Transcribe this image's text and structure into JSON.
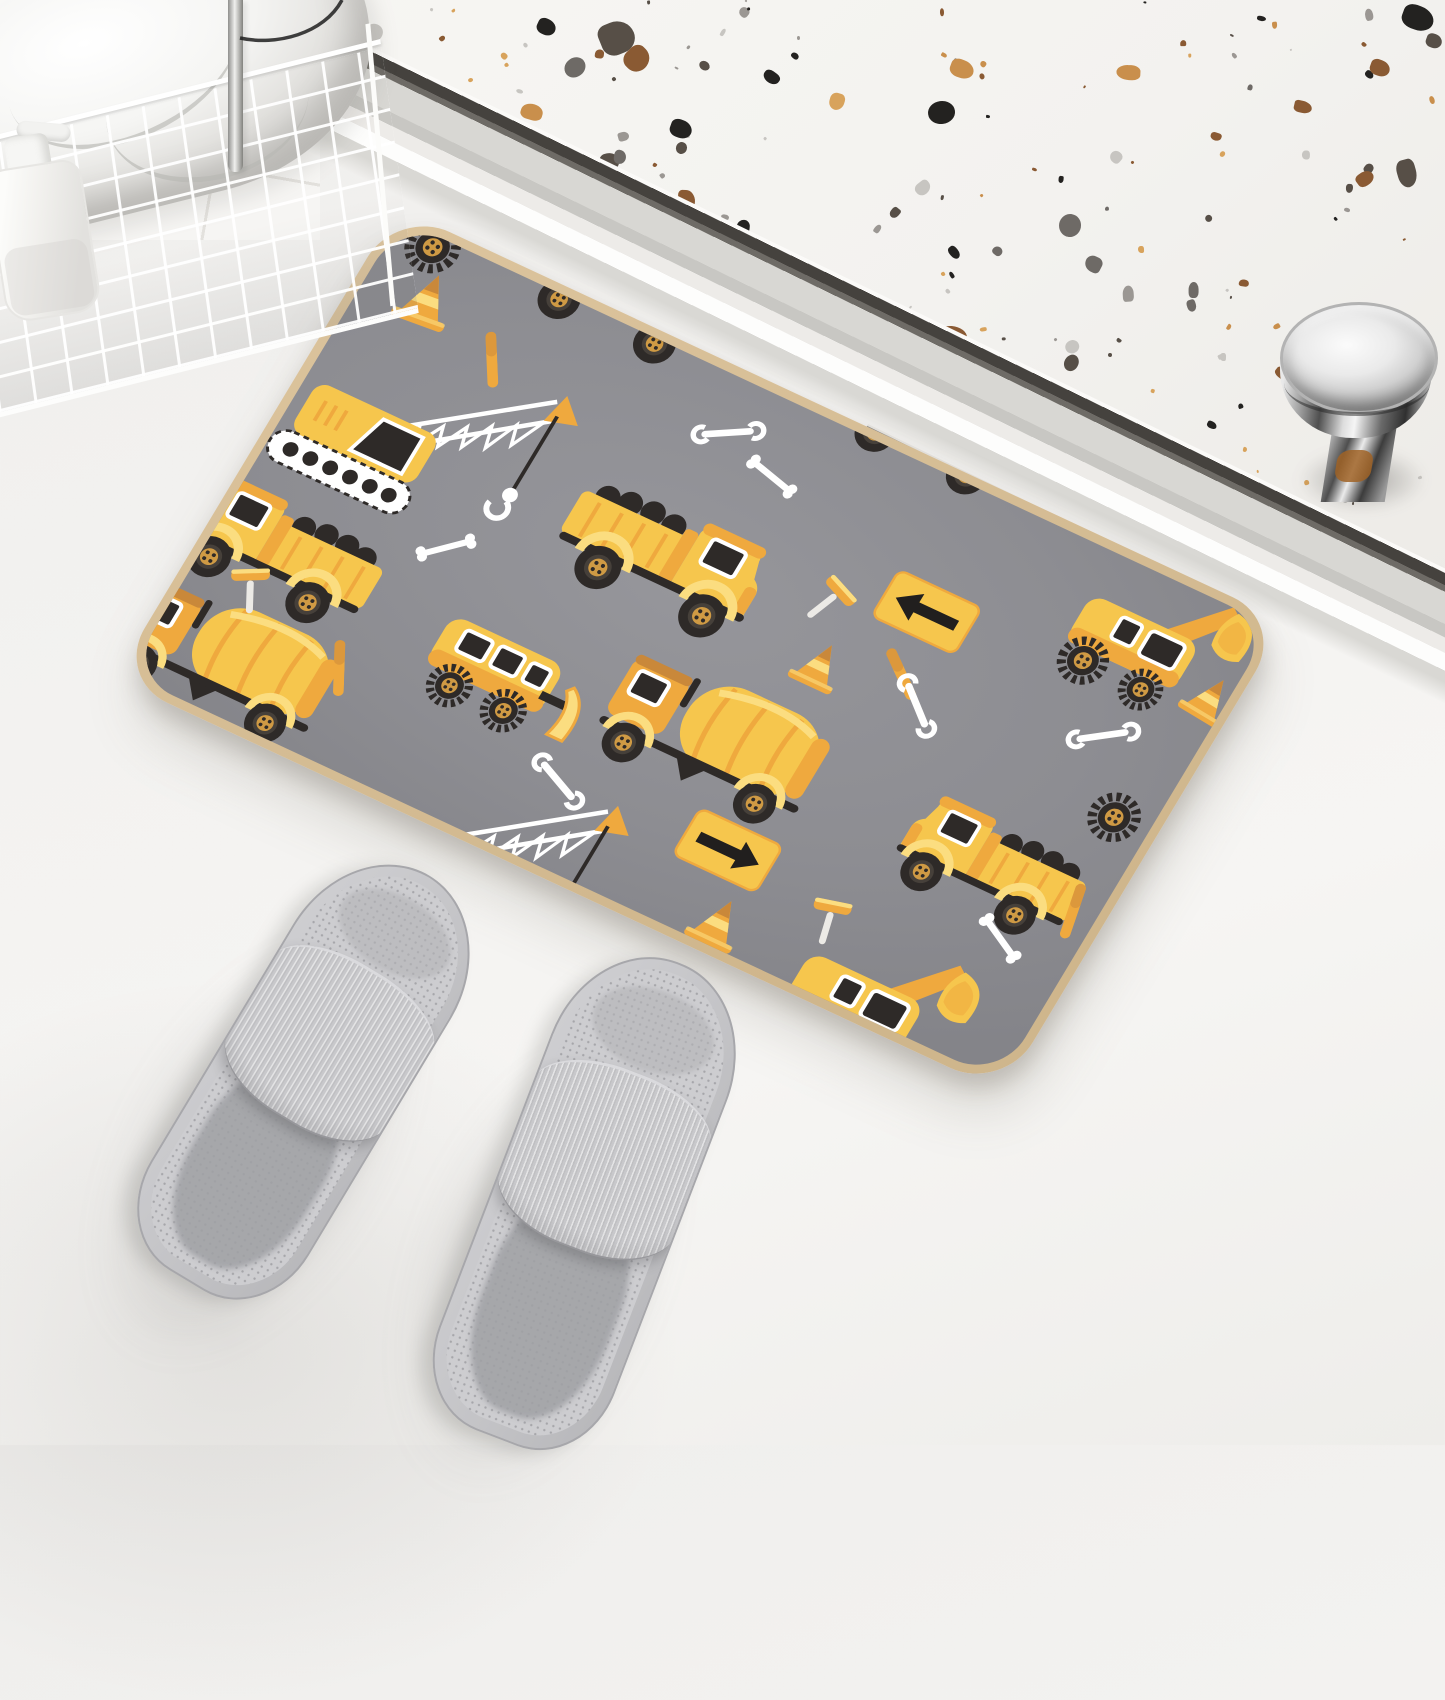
{
  "meta": {
    "scene": "bathroom product photo",
    "product": "construction vehicle pattern bath mat",
    "no_visible_text": true
  },
  "palette": {
    "y1": "#F6C64D",
    "y2": "#EFA93E",
    "y3": "#FBDD80",
    "o1": "#C9883A",
    "dk": "#2E2A28",
    "matField": "#8D8D92",
    "matBinding": "#DCC49D",
    "floor": "#F2F1EF",
    "terrazzoBg": "#F4F3F0",
    "slipper": "#C6C6C9",
    "towel": "#FFFFFF",
    "chrome": "#CFCFCF"
  },
  "terrazzo": {
    "seed": 12,
    "count": 270,
    "speckle_colors": [
      "#232220",
      "#574F47",
      "#8A5A33",
      "#C98F4C",
      "#D8A35C",
      "#C7C5C1",
      "#9B9793",
      "#6E6A66"
    ],
    "features": [
      {
        "x": 1152,
        "y": 6,
        "w": 32,
        "h": 24,
        "c": "#232220"
      },
      {
        "x": 1176,
        "y": 34,
        "w": 16,
        "h": 14,
        "c": "#574F47"
      },
      {
        "x": 1120,
        "y": 60,
        "w": 20,
        "h": 16,
        "c": "#8A5A33"
      },
      {
        "x": 700,
        "y": 60,
        "w": 24,
        "h": 18,
        "c": "#C98F4C"
      },
      {
        "x": 420,
        "y": 120,
        "w": 22,
        "h": 18,
        "c": "#232220"
      }
    ]
  },
  "mirror": {
    "blobs": [
      {
        "x": 18,
        "y": 8,
        "w": 72,
        "h": 26,
        "c": "#D8A94E"
      },
      {
        "x": 112,
        "y": 12,
        "w": 42,
        "h": 22,
        "c": "#55504A"
      },
      {
        "x": 186,
        "y": 6,
        "w": 82,
        "h": 30,
        "c": "#D8A94E"
      },
      {
        "x": 292,
        "y": 10,
        "w": 52,
        "h": 26,
        "c": "#8F8A84"
      }
    ]
  },
  "mat": {
    "items": [
      {
        "t": "gear",
        "x": 14,
        "y": -16,
        "r": 15
      },
      {
        "t": "truck",
        "x": 128,
        "y": -96,
        "s": 0.92
      },
      {
        "t": "cone",
        "x": 34,
        "y": 30,
        "s": 0.95,
        "r": -5
      },
      {
        "t": "stick",
        "x": 120,
        "y": 84,
        "r": 58
      },
      {
        "t": "wrench",
        "x": 356,
        "y": 42,
        "r": -30
      },
      {
        "t": "truck",
        "x": 470,
        "y": -104,
        "s": 0.88,
        "f": 1
      },
      {
        "t": "bone",
        "x": 420,
        "y": 66,
        "r": 14
      },
      {
        "t": "excav",
        "x": 770,
        "y": -6,
        "s": 0.95,
        "f": 1
      },
      {
        "t": "sign",
        "x": 608,
        "y": 102,
        "s": 0.92
      },
      {
        "t": "crane",
        "x": -10,
        "y": 86,
        "s": 1
      },
      {
        "t": "truck",
        "x": 296,
        "y": 122,
        "s": 1
      },
      {
        "t": "hammer",
        "x": 540,
        "y": 138,
        "r": 22
      },
      {
        "t": "cone",
        "x": 566,
        "y": 200,
        "s": 0.82
      },
      {
        "t": "stick",
        "x": 636,
        "y": 196,
        "r": 38
      },
      {
        "t": "gear",
        "x": 898,
        "y": 214,
        "s": 0.95
      },
      {
        "t": "wrench",
        "x": 836,
        "y": 158,
        "r": -35
      },
      {
        "t": "bone",
        "x": 176,
        "y": 268,
        "r": -42
      },
      {
        "t": "truck",
        "x": -44,
        "y": 282,
        "s": 0.95,
        "f": 1
      },
      {
        "t": "dozer",
        "x": 236,
        "y": 306,
        "s": 1
      },
      {
        "t": "mixer",
        "x": 424,
        "y": 262,
        "s": 1.02
      },
      {
        "t": "truck",
        "x": 736,
        "y": 272,
        "s": 0.9,
        "f": 1
      },
      {
        "t": "wrench",
        "x": 390,
        "y": 430,
        "r": 24
      },
      {
        "t": "sign",
        "x": 560,
        "y": 402,
        "s": 0.92,
        "f": 1
      },
      {
        "t": "hammer",
        "x": 706,
        "y": 428,
        "r": -14
      },
      {
        "t": "mixer",
        "x": -36,
        "y": 398,
        "s": 1
      },
      {
        "t": "crane",
        "x": 246,
        "y": 436,
        "s": 1
      },
      {
        "t": "cone",
        "x": 610,
        "y": 474,
        "s": 0.88
      },
      {
        "t": "excav",
        "x": 712,
        "y": 434,
        "s": 1,
        "f": 1
      },
      {
        "t": "stick",
        "x": 148,
        "y": 428,
        "r": 62
      },
      {
        "t": "bone",
        "x": 856,
        "y": 388,
        "r": 28
      },
      {
        "t": "cone",
        "x": 920,
        "y": 66,
        "s": 0.8,
        "r": 6
      },
      {
        "t": "stick",
        "x": 906,
        "y": 338,
        "r": 78
      },
      {
        "t": "hammer",
        "x": 36,
        "y": 372,
        "r": -28
      },
      {
        "t": "wrench",
        "x": 660,
        "y": 210,
        "r": 40
      }
    ]
  }
}
